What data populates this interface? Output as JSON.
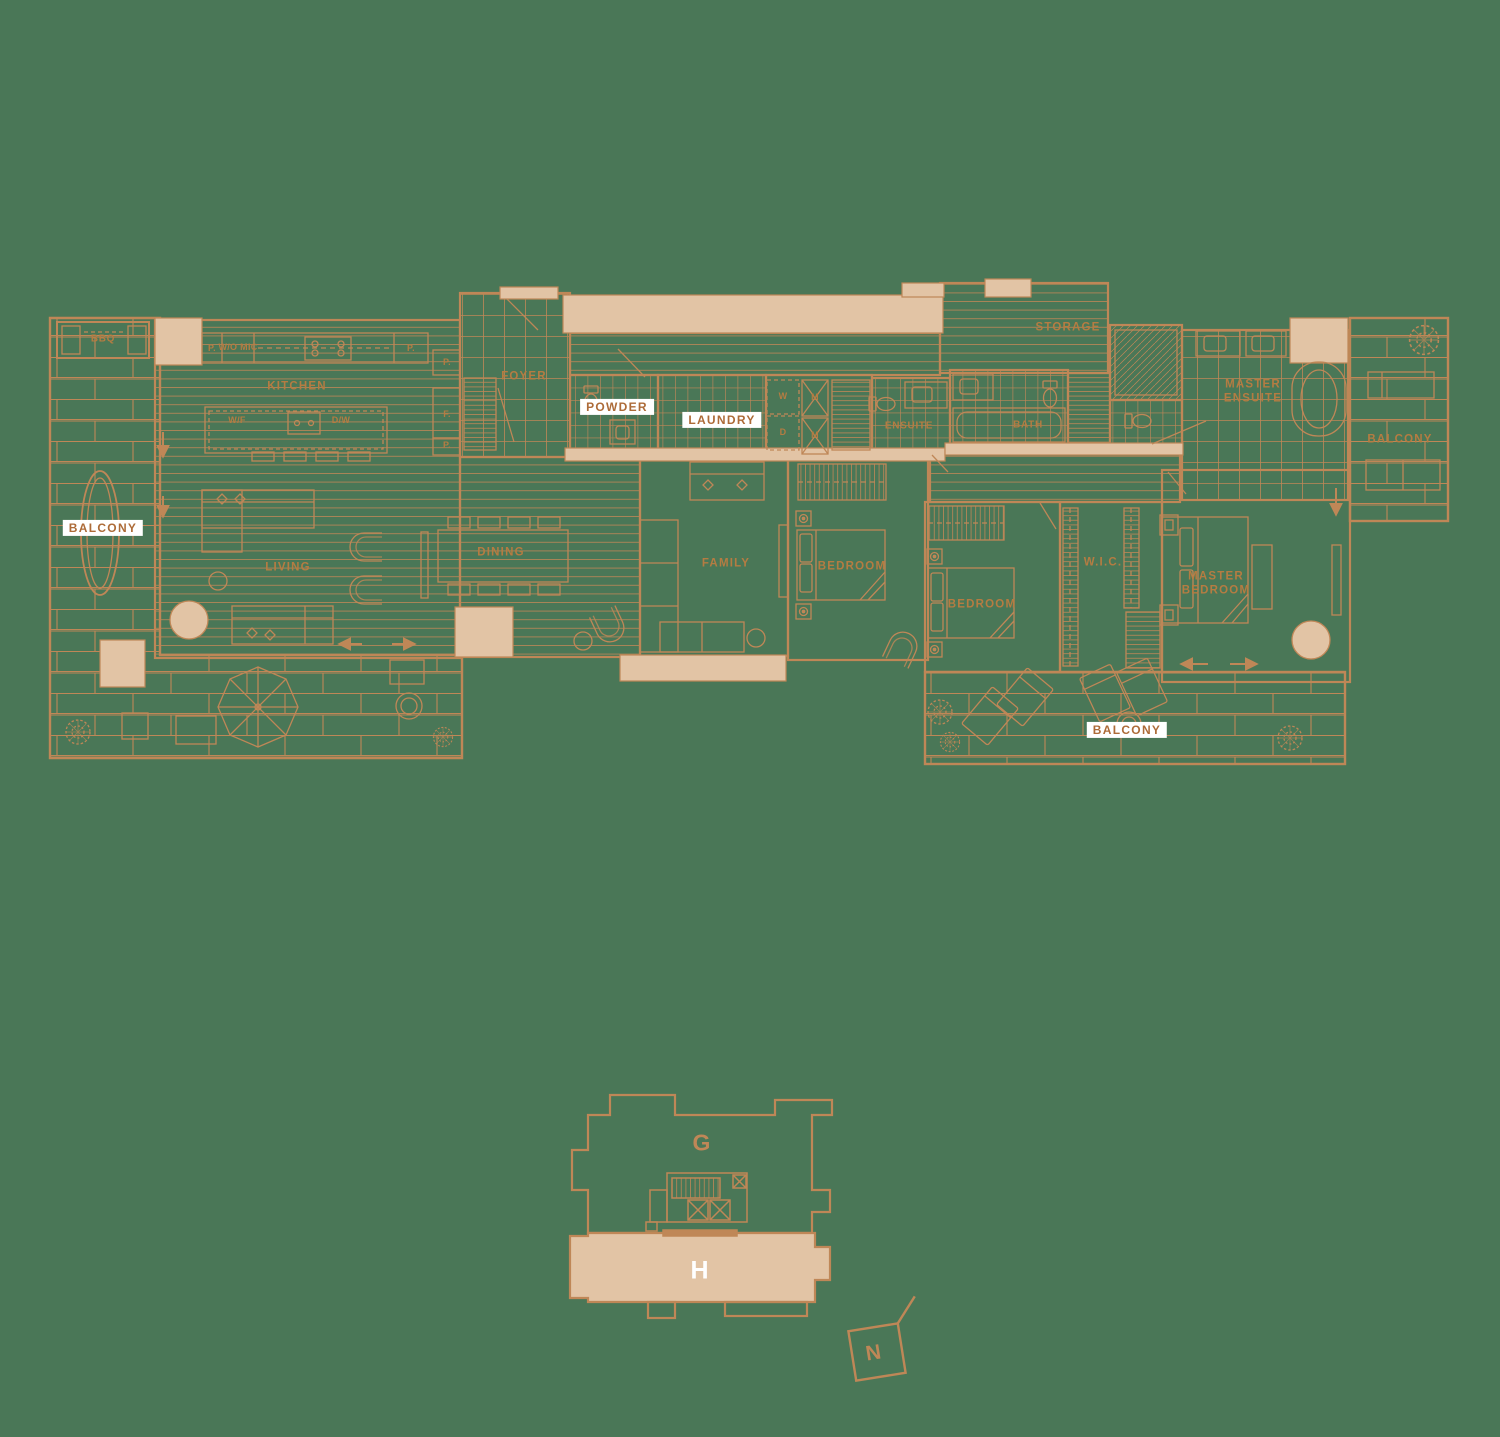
{
  "plan": {
    "rooms": {
      "bbq": "BBQ",
      "kitchen": "KITCHEN",
      "foyer": "FOYER",
      "powder": "POWDER",
      "laundry": "LAUNDRY",
      "ensuite": "ENSUITE",
      "bath": "BATH",
      "storage": "STORAGE",
      "master_ensuite": "MASTER ENSUITE",
      "living": "LIVING",
      "dining": "DINING",
      "family": "FAMILY",
      "bedroom": "BEDROOM",
      "wic": "W.I.C.",
      "master_bedroom": "MASTER BEDROOM",
      "balcony": "BALCONY"
    },
    "appliances": {
      "pantry": "P.",
      "wall_oven_micro": "W/O MIC",
      "wine_fridge": "W/F",
      "dishwasher": "D/W",
      "fridge": "F.",
      "washer": "W",
      "dryer": "D",
      "mech": "M"
    },
    "keyplan": {
      "unit_g": "G",
      "unit_h": "H",
      "north": "N"
    },
    "colors": {
      "background": "#4a7757",
      "line": "#bf8757",
      "fill": "#e2c4a5",
      "chip_bg": "#ffffff",
      "chip_text": "#ad6b38"
    }
  }
}
